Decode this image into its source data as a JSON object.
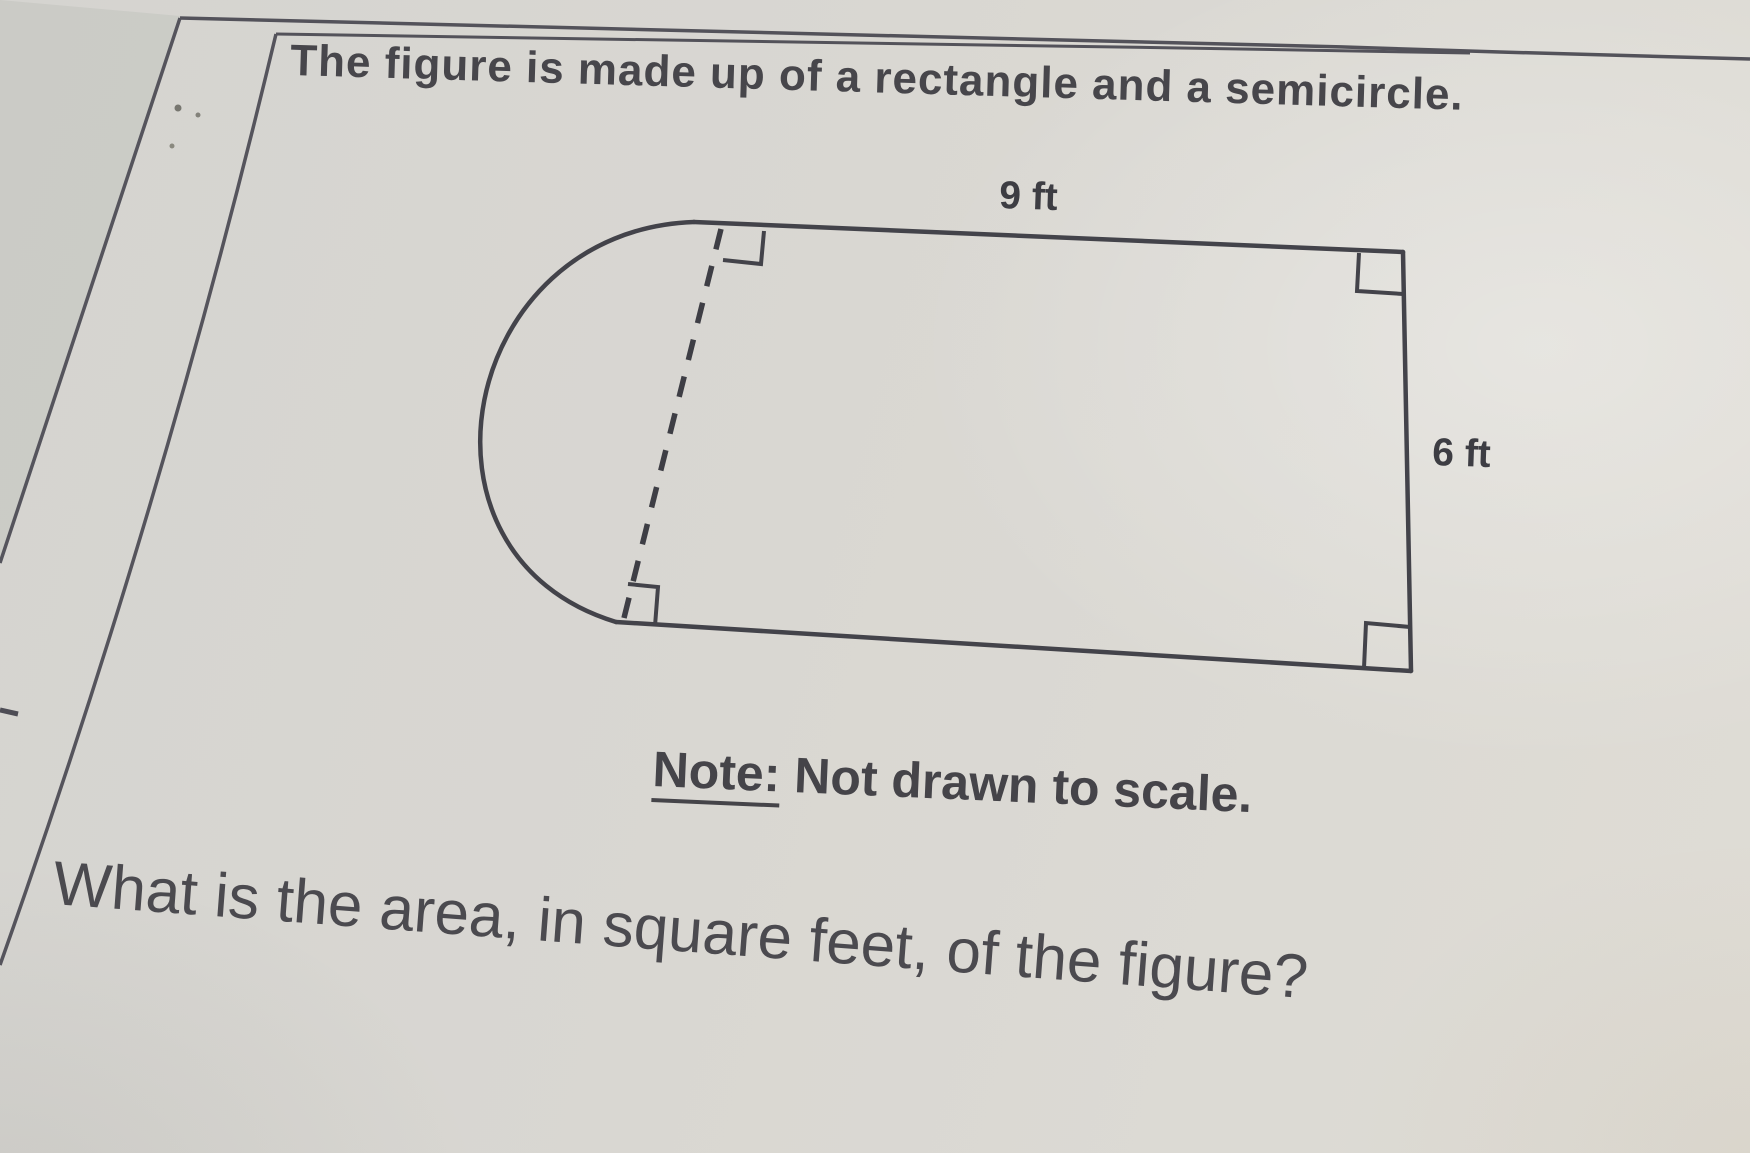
{
  "page": {
    "paper_color": "#d9d7d2",
    "ink_color": "#45444a"
  },
  "problem": {
    "intro": "The figure is made up of a rectangle and a semicircle.",
    "note_label": "Note:",
    "note_text": "Not drawn to scale.",
    "question": "What is the area, in square feet, of the figure?"
  },
  "figure": {
    "type": "composite-shape-diagram",
    "shapes": [
      "rectangle",
      "semicircle"
    ],
    "labels": {
      "top_width": "9 ft",
      "right_height": "6 ft"
    }
  }
}
